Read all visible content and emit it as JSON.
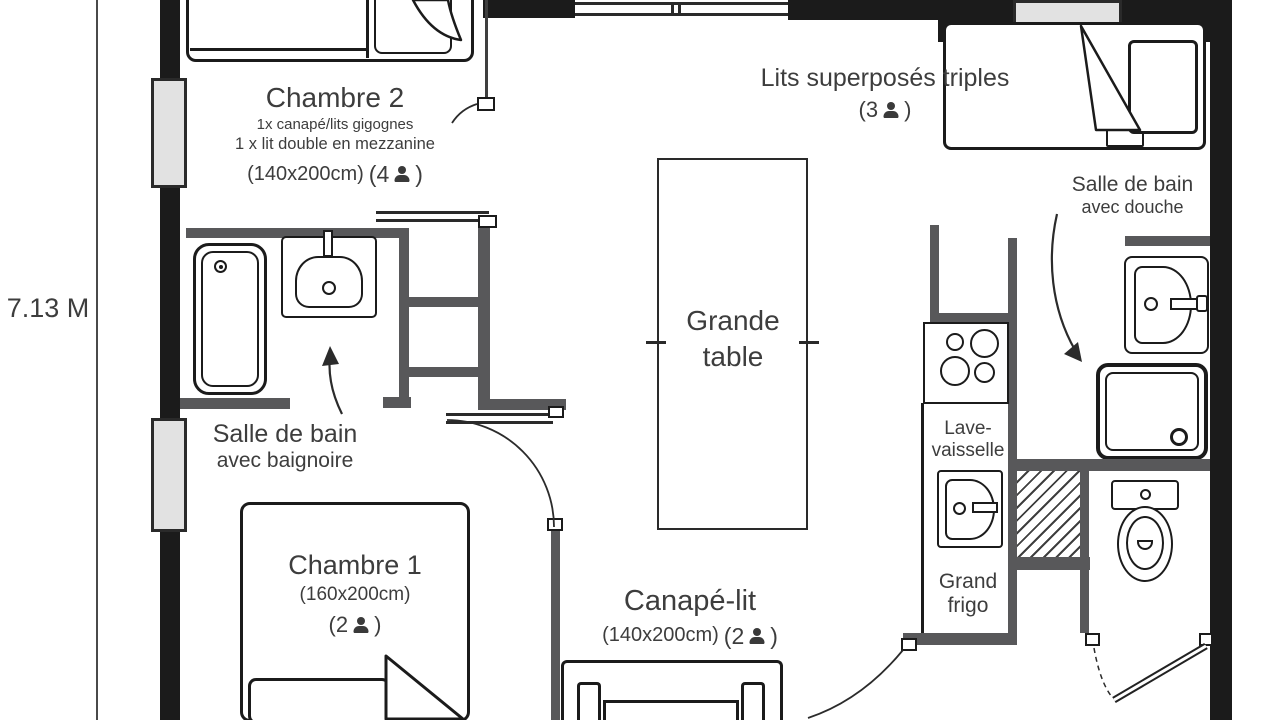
{
  "dimension": {
    "label": "7.13 M"
  },
  "chambre2": {
    "title": "Chambre 2",
    "detail1": "1x  canapé/lits gigognes",
    "detail2": "1 x lit double en mezzanine",
    "size": "(140x200cm)",
    "cap_open": "(4",
    "cap_close": ")"
  },
  "bunks": {
    "title": "Lits superposés triples",
    "cap_open": "(3",
    "cap_close": ")"
  },
  "bath_shower": {
    "line1": "Salle de bain",
    "line2": "avec douche"
  },
  "bath_tub": {
    "line1": "Salle de bain",
    "line2": "avec baignoire"
  },
  "table": {
    "line1": "Grande",
    "line2": "table"
  },
  "chambre1": {
    "title": "Chambre 1",
    "size": "(160x200cm)",
    "cap_open": "(2",
    "cap_close": ")"
  },
  "sofa": {
    "title": "Canapé-lit",
    "size": "(140x200cm)",
    "cap_open": "(2",
    "cap_close": ")"
  },
  "dishwasher": {
    "line1": "Lave-",
    "line2": "vaisselle"
  },
  "fridge": {
    "line1": "Grand",
    "line2": "frigo"
  }
}
